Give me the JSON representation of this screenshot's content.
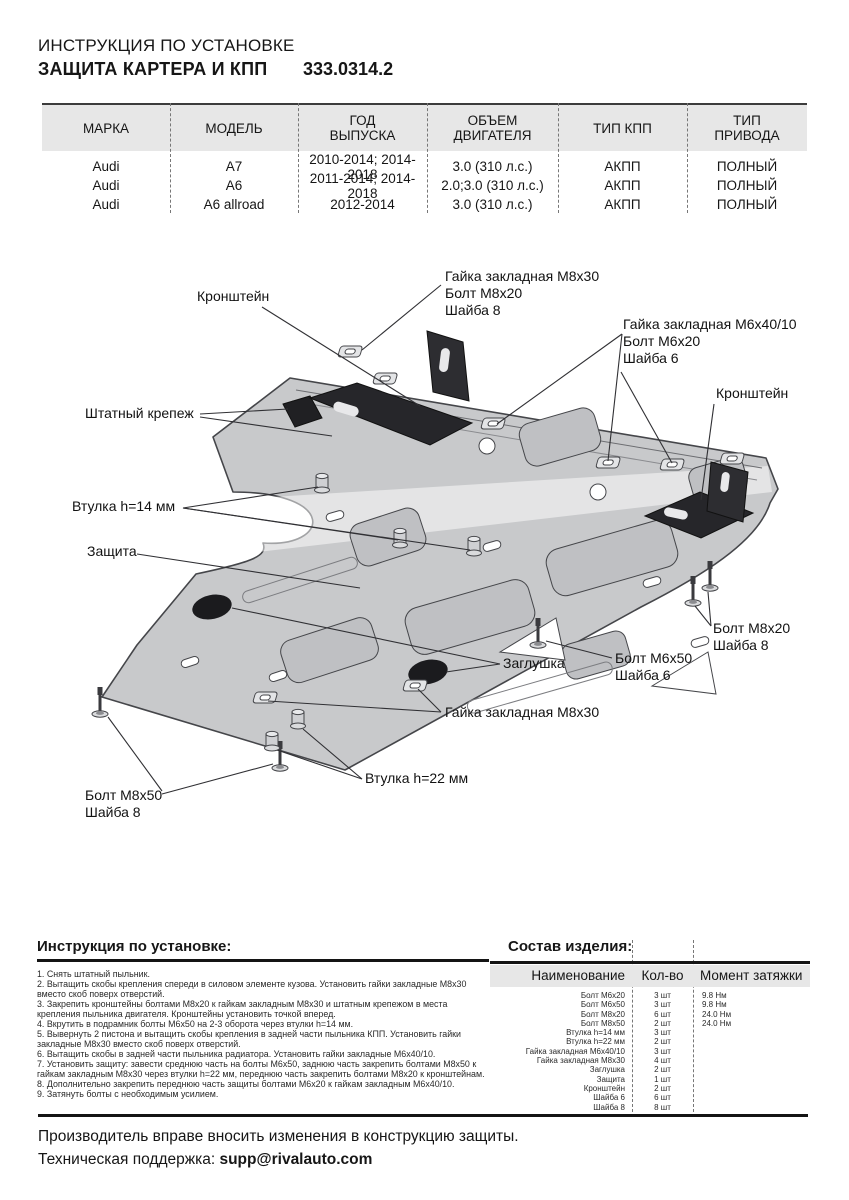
{
  "header": {
    "doc_type": "ИНСТРУКЦИЯ ПО УСТАНОВКЕ",
    "product": "ЗАЩИТА КАРТЕРА И КПП",
    "part_number": "333.0314.2"
  },
  "vehicle_table": {
    "headers": [
      "МАРКА",
      "МОДЕЛЬ",
      "ГОД\nВЫПУСКА",
      "ОБЪЕМ\nДВИГАТЕЛЯ",
      "ТИП КПП",
      "ТИП\nПРИВОДА"
    ],
    "rows": [
      [
        "Audi",
        "A7",
        "2010-2014; 2014-2018",
        "3.0 (310 л.с.)",
        "АКПП",
        "ПОЛНЫЙ"
      ],
      [
        "Audi",
        "A6",
        "2011-2014; 2014-2018",
        "2.0;3.0 (310 л.с.)",
        "АКПП",
        "ПОЛНЫЙ"
      ],
      [
        "Audi",
        "A6 allroad",
        "2012-2014",
        "3.0 (310 л.с.)",
        "АКПП",
        "ПОЛНЫЙ"
      ]
    ]
  },
  "diagram": {
    "labels": {
      "bracket_left": "Кронштейн",
      "nut_bolt_top": "Гайка закладная М8х30\nБолт М8х20\nШайба 8",
      "nut_bolt_right": "Гайка закладная М6х40/10\nБолт М6х20\nШайба 6",
      "bracket_right": "Кронштейн",
      "factory_fastener": "Штатный крепеж",
      "bushing_14": "Втулка h=14 мм",
      "guard": "Защита",
      "bolt_m8x20": "Болт М8х20\nШайба 8",
      "bolt_m6x50": "Болт М6х50\nШайба 6",
      "plug": "Заглушка",
      "nut_m8x30": "Гайка закладная М8х30",
      "bushing_22": "Втулка h=22 мм",
      "bolt_m8x50": "Болт М8х50\nШайба 8"
    }
  },
  "instructions": {
    "heading": "Инструкция по установке:",
    "steps": [
      "1. Снять штатный пыльник.",
      "2. Вытащить скобы крепления спереди в силовом элементе кузова. Установить гайки закладные М8х30 вместо скоб поверх отверстий.",
      "3. Закрепить кронштейны болтами М8х20 к гайкам закладным М8х30 и штатным крепежом в места крепления пыльника двигателя. Кронштейны установить точкой вперед.",
      "4. Вкрутить в подрамник болты М6х50 на 2-3 оборота через втулки h=14 мм.",
      "5. Вывернуть 2 пистона и вытащить скобы крепления в задней части пыльника КПП. Установить гайки закладные М8х30 вместо скоб поверх отверстий.",
      "6. Вытащить скобы в задней части пыльника радиатора. Установить гайки закладные М6х40/10.",
      "7. Установить защиту: завести среднюю часть на болты М6х50, заднюю часть закрепить болтами М8х50 к гайкам закладным М8х30 через втулки h=22 мм, переднюю часть закрепить болтами М8х20 к кронштейнам.",
      "8. Дополнительно закрепить переднюю часть защиты болтами М6х20 к гайкам закладным М6х40/10.",
      "9. Затянуть болты с необходимым усилием."
    ]
  },
  "parts": {
    "heading": "Состав изделия:",
    "headers": [
      "Наименование",
      "Кол-во",
      "Момент затяжки"
    ],
    "rows": [
      [
        "Болт М6х20",
        "3 шт",
        "9.8 Нм"
      ],
      [
        "Болт М6х50",
        "3 шт",
        "9.8 Нм"
      ],
      [
        "Болт М8х20",
        "6 шт",
        "24.0 Нм"
      ],
      [
        "Болт М8х50",
        "2 шт",
        "24.0 Нм"
      ],
      [
        "Втулка h=14 мм",
        "3 шт",
        ""
      ],
      [
        "Втулка h=22 мм",
        "2 шт",
        ""
      ],
      [
        "Гайка закладная М6х40/10",
        "3 шт",
        ""
      ],
      [
        "Гайка закладная М8х30",
        "4 шт",
        ""
      ],
      [
        "Заглушка",
        "2 шт",
        ""
      ],
      [
        "Защита",
        "1 шт",
        ""
      ],
      [
        "Кронштейн",
        "2 шт",
        ""
      ],
      [
        "Шайба 6",
        "6 шт",
        ""
      ],
      [
        "Шайба 8",
        "8 шт",
        ""
      ]
    ]
  },
  "footer": {
    "disclaimer": "Производитель вправе вносить изменения в конструкцию защиты.",
    "support_label": "Техническая поддержка: ",
    "support_email": "supp@rivalauto.com"
  },
  "colors": {
    "plate": "#c8c9cb",
    "plate_cutout": "#bfc0c3",
    "outline": "#45464a",
    "bracket": "#26262a",
    "table_header_bg": "#e7e7e7",
    "rule": "#141414"
  }
}
